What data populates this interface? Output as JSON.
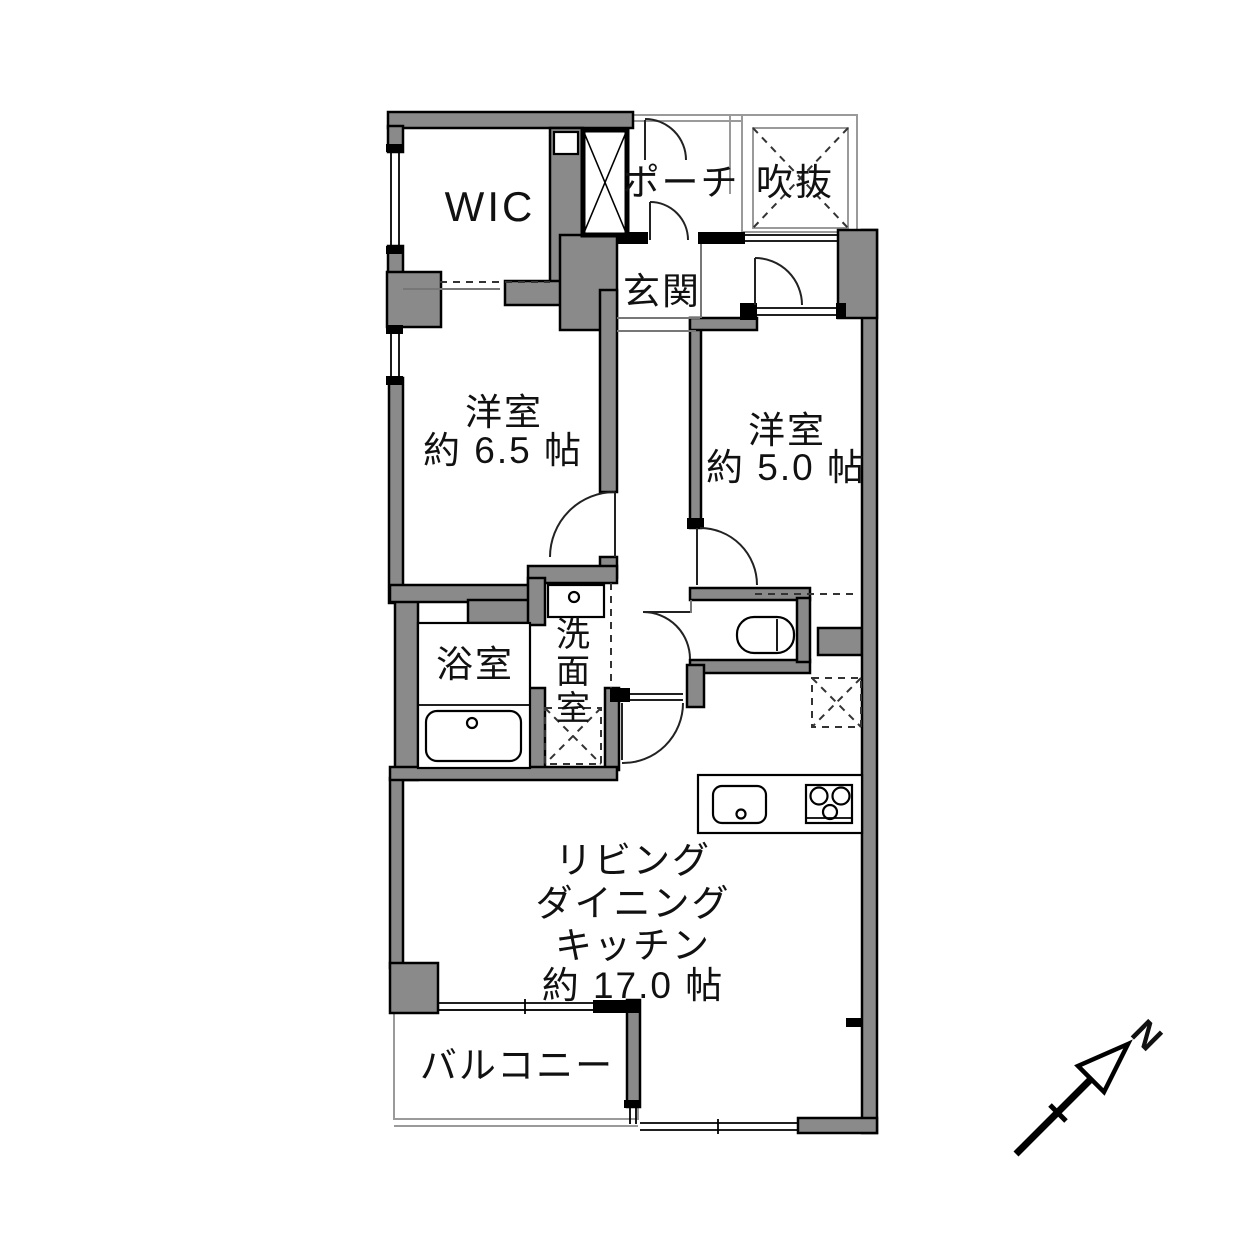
{
  "floor_plan": {
    "rooms": {
      "wic": {
        "label": "WIC"
      },
      "porch": {
        "label": "ポーチ"
      },
      "void": {
        "label": "吹抜"
      },
      "entrance": {
        "label": "玄関"
      },
      "bedroom_west": {
        "name": "洋室",
        "size": "約 6.5 帖"
      },
      "bedroom_east": {
        "name": "洋室",
        "size": "約 5.0 帖"
      },
      "bathroom": {
        "label": "浴室"
      },
      "washroom": {
        "label_chars": [
          "洗",
          "面",
          "室"
        ]
      },
      "ldk": {
        "lines": [
          "リビング",
          "ダイニング",
          "キッチン",
          "約 17.0 帖"
        ]
      },
      "balcony": {
        "label": "バルコニー"
      }
    },
    "compass": {
      "north_label": "N"
    },
    "colors": {
      "background": "#ffffff",
      "wall_fill": "#8a8a8a",
      "wall_stroke": "#000000",
      "thin_line": "#9a9a9a",
      "dashed_line": "#333333",
      "text": "#111111"
    }
  }
}
